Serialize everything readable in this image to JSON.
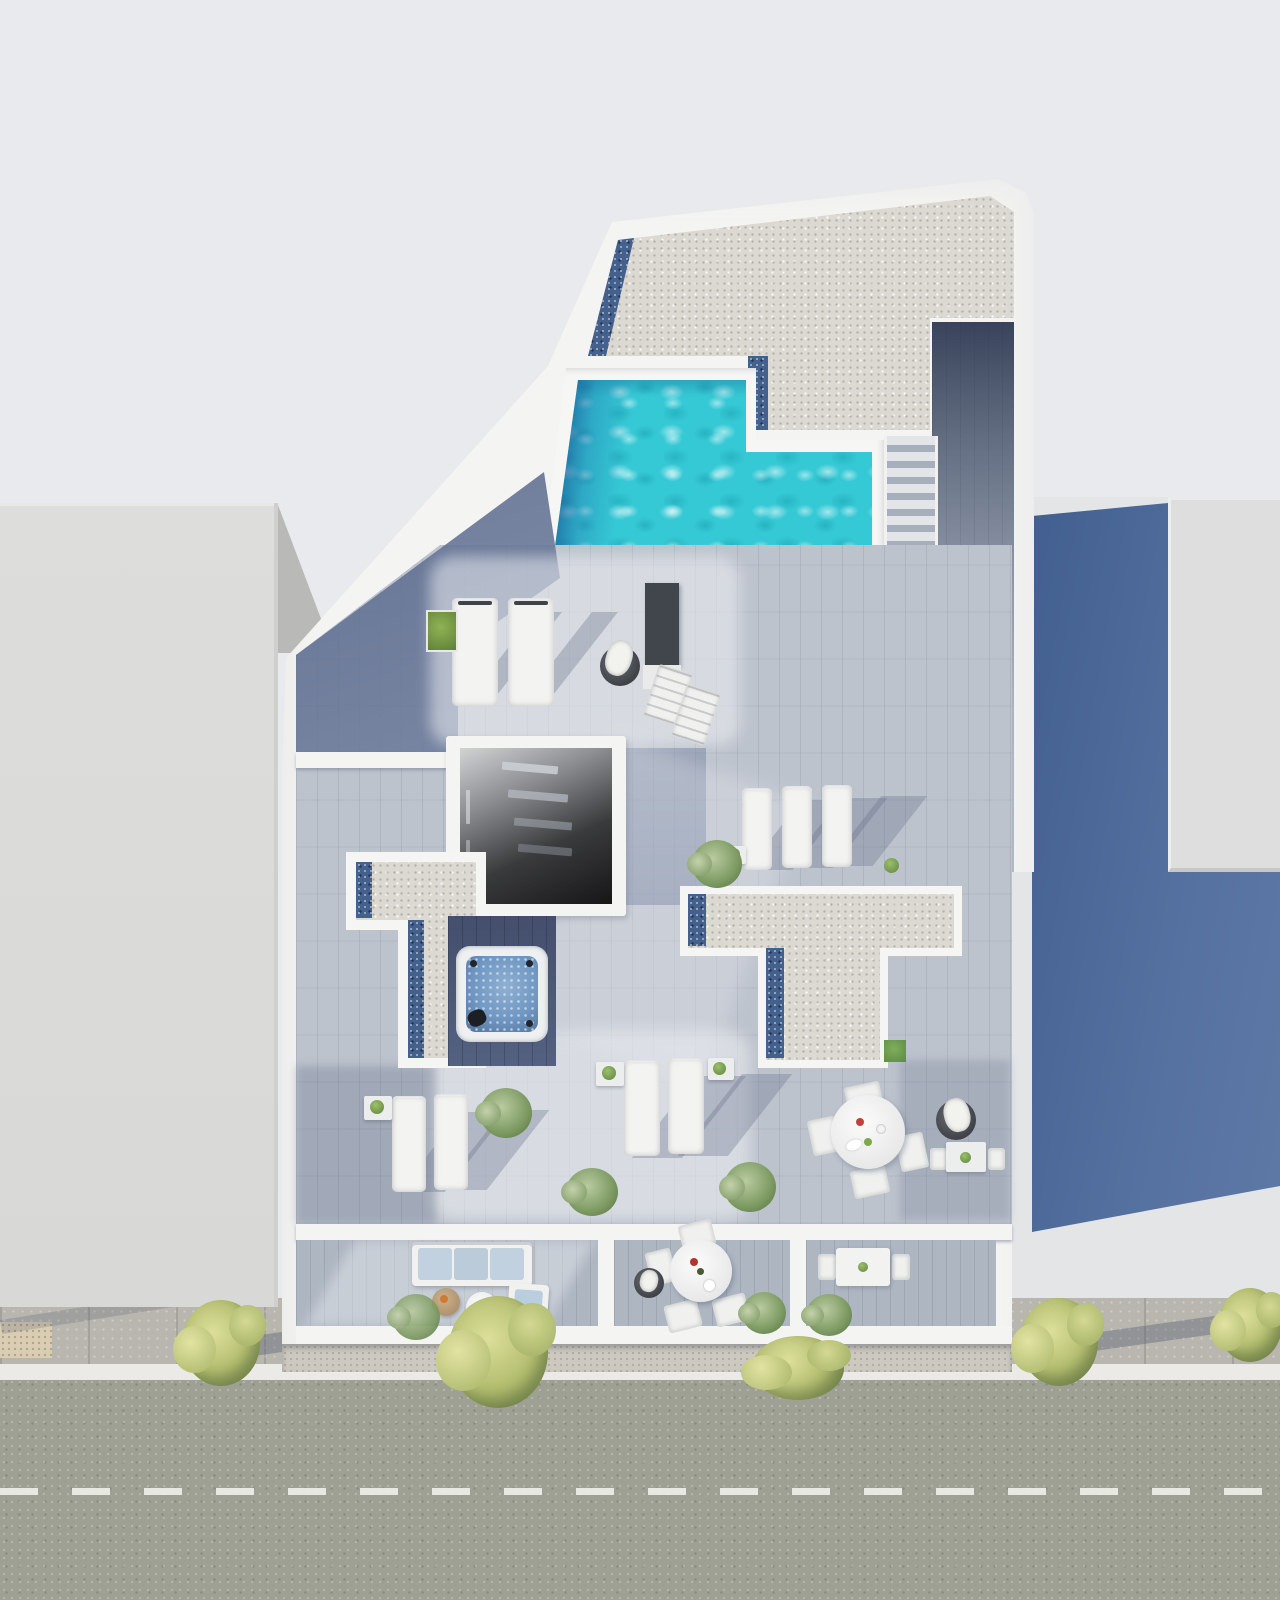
{
  "scene": {
    "title": "Aerial top-down 3D rendering of a rooftop terrace with swimming pool",
    "view": "top-down axonometric render",
    "visible_text": "none"
  },
  "palette": {
    "background": "#e9eaed",
    "walls_white": "#f4f4f2",
    "gravel_roof": "#dcd9d2",
    "gravel_blue_strip": "#44608c",
    "deck_wood_light": "#c6ccd5",
    "deck_wood_base": "#bdc3cd",
    "deck_shadow_blue": "#5d6d92",
    "pool_turquoise": "#35c9d5",
    "pool_dark_edge": "#1c5f99",
    "jacuzzi_water": "#6f97c2",
    "cast_shadow_blue": "#4e6a99",
    "street_asphalt": "#9da092",
    "sidewalk": "#b8b6ae",
    "curb_line": "#eceae6",
    "tree_foliage": "#b3bd6f",
    "bush_foliage": "#7d9a62",
    "grass_patch": "#6f9c50",
    "sofa_cushion_blue": "#c2d1df"
  },
  "labels": {
    "stage": "Aerial rooftop render",
    "street": "Street with dashed center line",
    "sidewalk": "Sidewalk with street trees",
    "left_building": "Neighbouring building (left)",
    "right_building": "Neighbouring building (right)",
    "cast_shadow": "Building cast shadow",
    "building": "Main building rooftop",
    "gravel_roof": "Gravel roof section",
    "pool": "Swimming pool",
    "stairs": "Pool deck stairs",
    "walkway": "Side walkway",
    "skylight_1": "Open skylight courtyard (upper)",
    "skylight_2": "Open skylight courtyard (lower)",
    "gravel_t_left": "Gravel roof T-section (left)",
    "gravel_t_right": "Gravel roof T-section (right)",
    "jacuzzi": "Jacuzzi hot tub",
    "sunbed": "Double sunbed",
    "lounger": "Sun lounger",
    "dining_set": "Round dining table with chairs",
    "sofa": "Outdoor sofa with blue cushions",
    "balcony": "Street-side balcony",
    "tree": "Street tree",
    "plant": "Potted plant"
  },
  "inventory": {
    "neighbor_buildings": 2,
    "skylight_courtyards": 2,
    "gravel_terraces": 3,
    "sunbeds_top": 2,
    "sun_loungers": 7,
    "folding_deck_chairs": 2,
    "round_dining_sets": 2,
    "small_table_sets": 2,
    "sofas": 1,
    "armchairs": 1,
    "coffee_tables": 2,
    "poufs": 3,
    "jacuzzi": 1,
    "pools": 1,
    "street_trees": 5,
    "deck_plants": 10,
    "road_markings": "white dashed center line"
  }
}
